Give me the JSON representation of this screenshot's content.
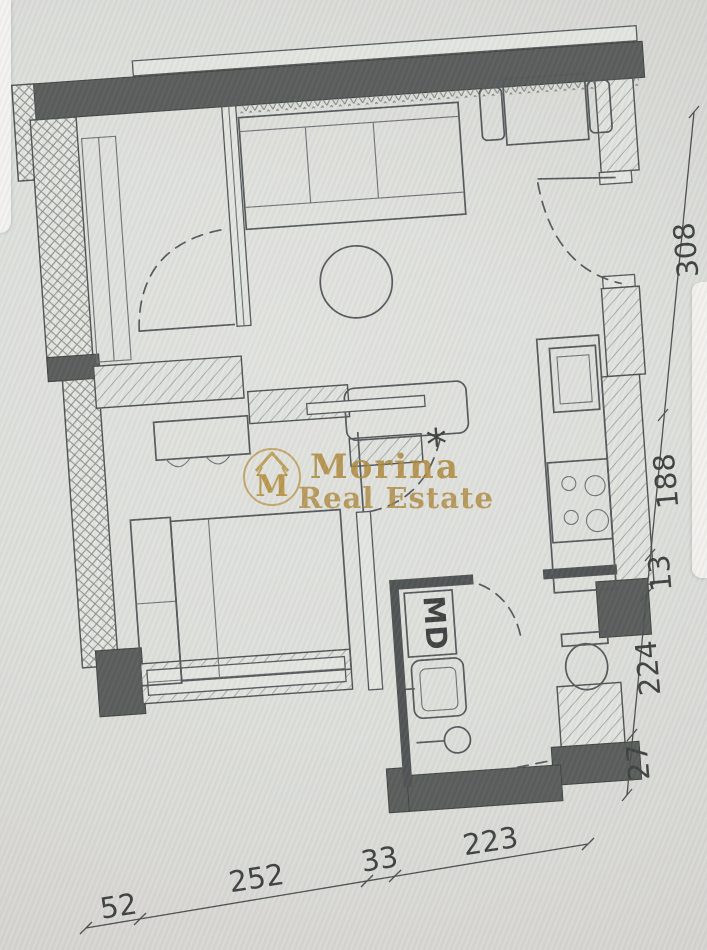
{
  "watermark": {
    "monogram": "M",
    "line1": "Morina",
    "line2": "Real Estate"
  },
  "plan": {
    "closet_label": "MD",
    "symbol": "*"
  },
  "dimensions": {
    "right": [
      "308",
      "188",
      "13",
      "224",
      "27"
    ],
    "bottom": [
      "52",
      "252",
      "33",
      "223"
    ]
  },
  "colors": {
    "wall_dark": "#575b5a",
    "wall_darker": "#4e5252",
    "paper": "#dfe0dc",
    "background": "#d8d6d3",
    "line": "#53575a",
    "hatch": "#989c98",
    "watermark_gold": "#ad873a",
    "card_white": "#f4f3f1"
  }
}
